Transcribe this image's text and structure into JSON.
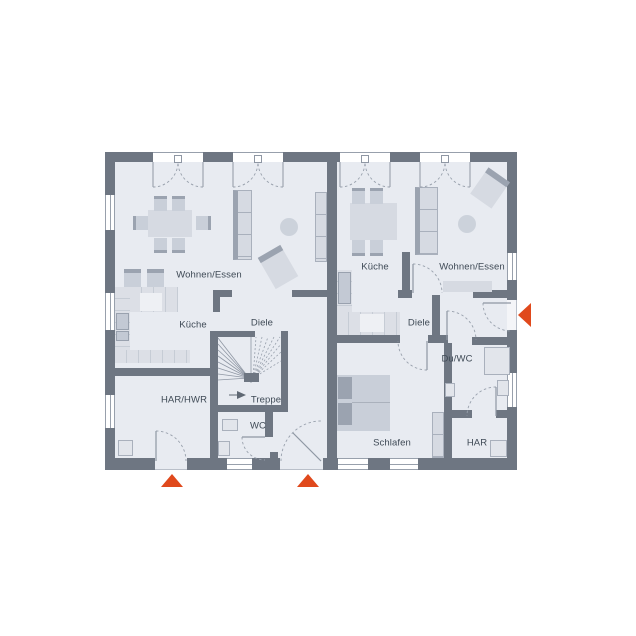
{
  "plan": {
    "title": "Erdgeschoss Doppelhaus Grundriss",
    "units": [
      {
        "id": "left",
        "rooms": [
          {
            "id": "wohnen-essen",
            "label": "Wohnen/Essen"
          },
          {
            "id": "kueche",
            "label": "Küche"
          },
          {
            "id": "diele",
            "label": "Diele"
          },
          {
            "id": "treppe",
            "label": "Treppe"
          },
          {
            "id": "wc",
            "label": "WC"
          },
          {
            "id": "har-hwr",
            "label": "HAR/HWR"
          }
        ]
      },
      {
        "id": "right",
        "rooms": [
          {
            "id": "kueche",
            "label": "Küche"
          },
          {
            "id": "wohnen-essen",
            "label": "Wohnen/Essen"
          },
          {
            "id": "diele",
            "label": "Diele"
          },
          {
            "id": "du-wc",
            "label": "Du/WC"
          },
          {
            "id": "schlafen",
            "label": "Schlafen"
          },
          {
            "id": "har",
            "label": "HAR"
          }
        ]
      }
    ],
    "markers": [
      {
        "id": "entrance-marker-left-unit-har",
        "shape": "triangle-up",
        "color": "#e0491c"
      },
      {
        "id": "entrance-marker-left-unit-diele",
        "shape": "triangle-up",
        "color": "#e0491c"
      },
      {
        "id": "entrance-marker-right-unit",
        "shape": "triangle-left",
        "color": "#e0491c"
      }
    ],
    "colors": {
      "wall": "#6e7682",
      "floor": "#e8ebf1",
      "accent": "#e0491c",
      "furniture": "#d6dae2",
      "text": "#3f4a56",
      "line": "#98a0ac"
    }
  }
}
